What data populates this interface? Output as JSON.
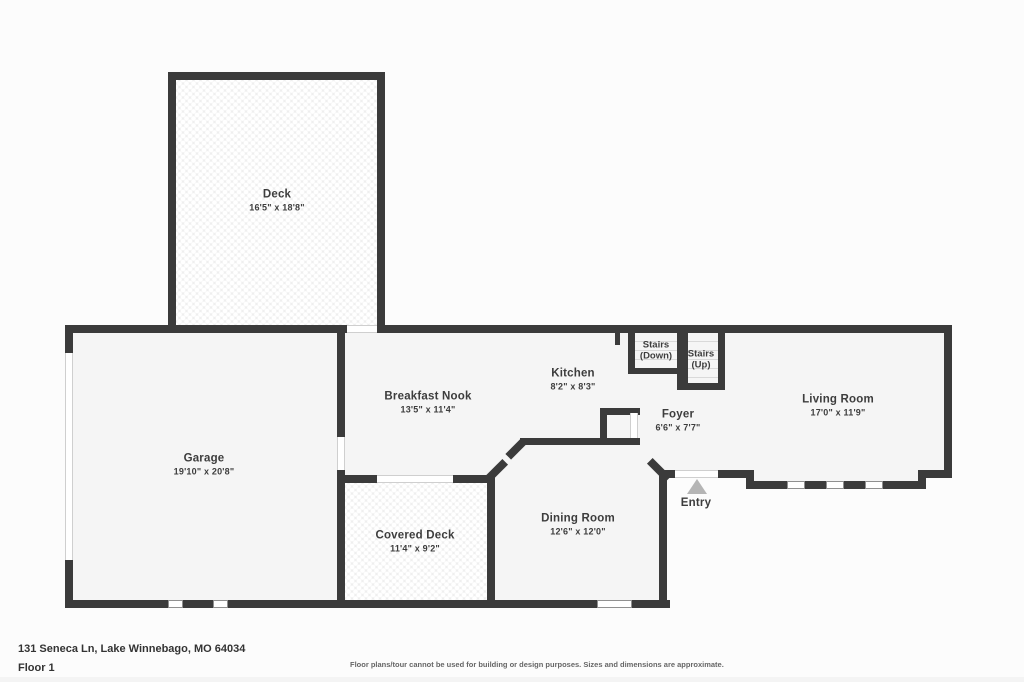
{
  "colors": {
    "page_bg": "#fcfcfc",
    "room_fill": "#f5f5f5",
    "wall": "#3b3b3b",
    "deck_fill": "#efefef",
    "window_fill": "#ffffff",
    "entry_arrow": "#b5b5b5",
    "label_text": "#3d3d3d",
    "disclaimer_text": "#666666"
  },
  "rooms": {
    "deck": {
      "name": "Deck",
      "dims": "16'5\" x 18'8\""
    },
    "garage": {
      "name": "Garage",
      "dims": "19'10\" x 20'8\""
    },
    "breakfast_nook": {
      "name": "Breakfast Nook",
      "dims": "13'5\" x 11'4\""
    },
    "kitchen": {
      "name": "Kitchen",
      "dims": "8'2\" x 8'3\""
    },
    "stairs_down": {
      "name": "Stairs (Down)"
    },
    "stairs_up": {
      "name": "Stairs (Up)"
    },
    "foyer": {
      "name": "Foyer",
      "dims": "6'6\" x 7'7\""
    },
    "living_room": {
      "name": "Living Room",
      "dims": "17'0\" x 11'9\""
    },
    "covered_deck": {
      "name": "Covered Deck",
      "dims": "11'4\" x 9'2\""
    },
    "dining_room": {
      "name": "Dining Room",
      "dims": "12'6\" x 12'0\""
    },
    "entry": {
      "name": "Entry"
    }
  },
  "footer": {
    "address": "131 Seneca Ln, Lake Winnebago, MO 64034",
    "floor_label": "Floor 1",
    "disclaimer": "Floor plans/tour cannot be used for building or design purposes. Sizes and dimensions are approximate."
  }
}
